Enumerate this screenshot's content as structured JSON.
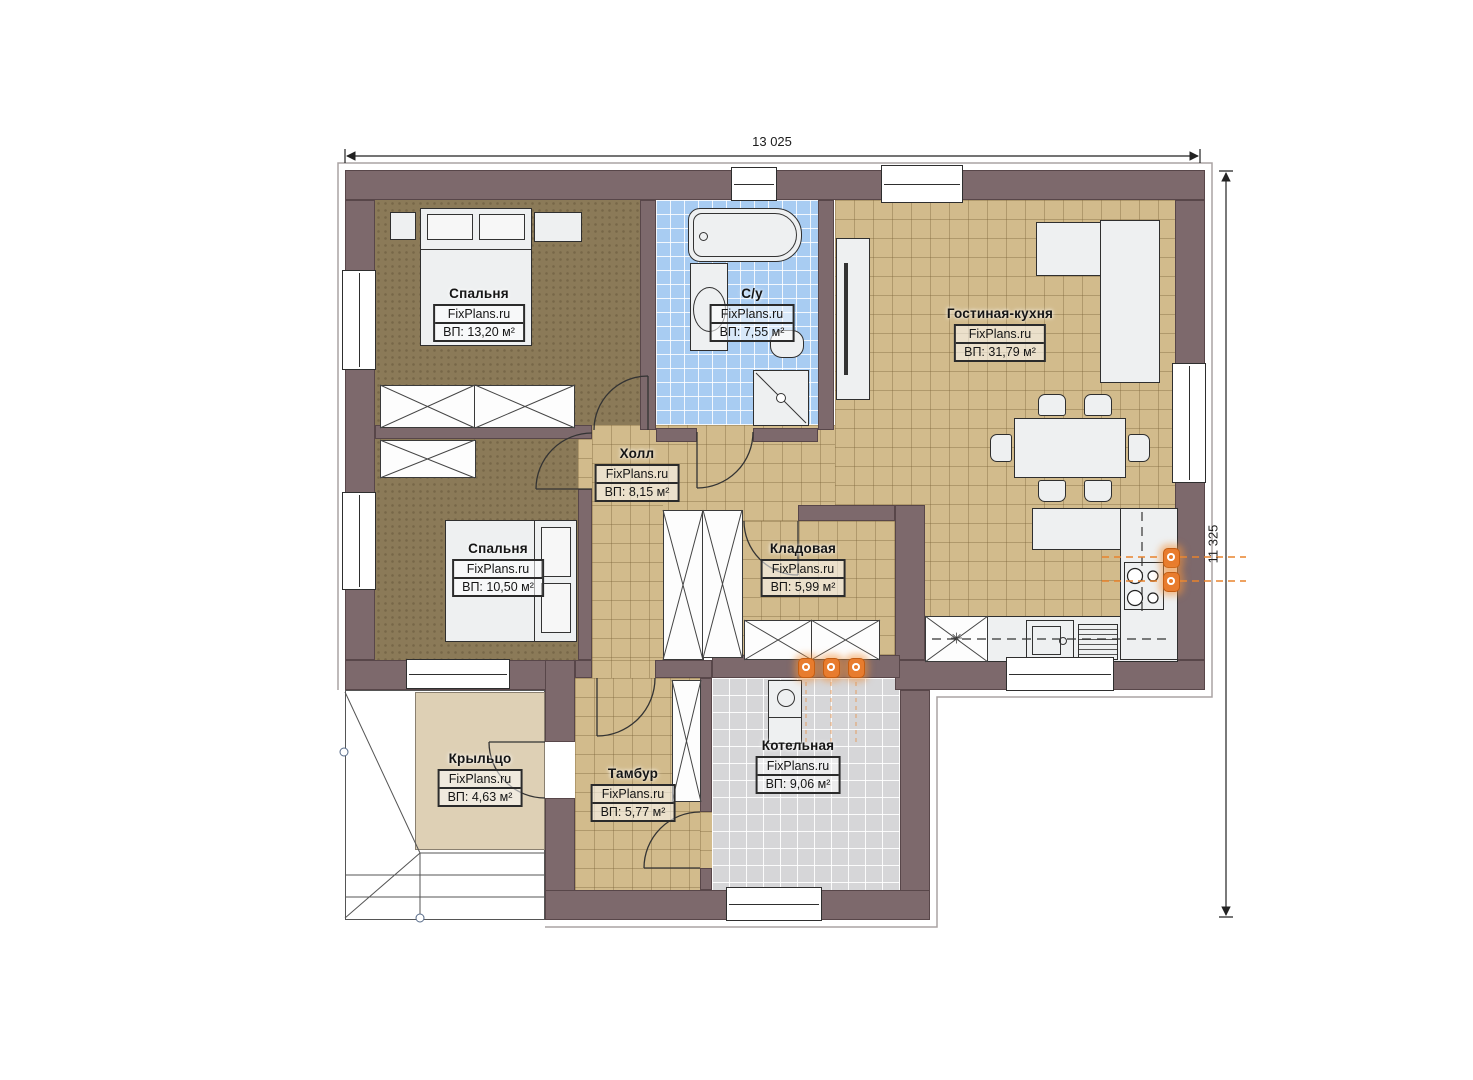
{
  "dimensions": {
    "width": "13 025",
    "height": "11 325"
  },
  "rooms": [
    {
      "name": "Спальня",
      "watermark": "FixPlans.ru",
      "area": "ВП: 13,20 м²"
    },
    {
      "name": "С/у",
      "watermark": "FixPlans.ru",
      "area": "ВП: 7,55 м²"
    },
    {
      "name": "Гостиная-кухня",
      "watermark": "FixPlans.ru",
      "area": "ВП: 31,79 м²"
    },
    {
      "name": "Холл",
      "watermark": "FixPlans.ru",
      "area": "ВП: 8,15 м²"
    },
    {
      "name": "Спальня",
      "watermark": "FixPlans.ru",
      "area": "ВП: 10,50 м²"
    },
    {
      "name": "Кладовая",
      "watermark": "FixPlans.ru",
      "area": "ВП: 5,99 м²"
    },
    {
      "name": "Крыльцо",
      "watermark": "FixPlans.ru",
      "area": "ВП: 4,63 м²"
    },
    {
      "name": "Тамбур",
      "watermark": "FixPlans.ru",
      "area": "ВП: 5,77 м²"
    },
    {
      "name": "Котельная",
      "watermark": "FixPlans.ru",
      "area": "ВП: 9,06 м²"
    }
  ],
  "icons": {
    "fridge_snowflake": "✳"
  },
  "colors": {
    "wall": "#7d696c",
    "floor_tile_tan": "#d2bb8c",
    "floor_tile_blue": "#a8ccf2",
    "floor_tile_gray": "#d6d6d8",
    "floor_bedroom_brown": "#8b7a58",
    "floor_porch_beige": "#ded0b5",
    "accent_orange": "#e87c2e"
  }
}
